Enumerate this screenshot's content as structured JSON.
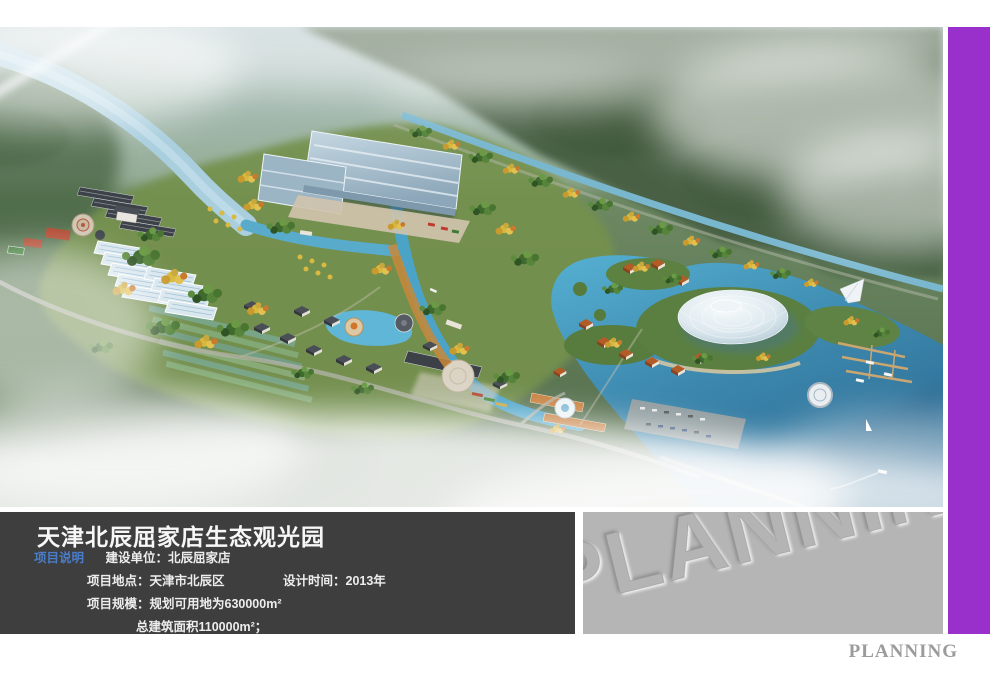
{
  "board": {
    "title": "天津北辰屈家店生态观光园",
    "section_label": "项目说明",
    "owner": "建设单位：北辰屈家店",
    "location": "项目地点：天津市北辰区",
    "design_time": "设计时间：2013年",
    "scale": "项目规模：规划可用地为630000m²",
    "area": "总建筑面积110000m²；"
  },
  "watermark": {
    "embossed": "PLANNING",
    "footer": "PLANNING"
  },
  "colors": {
    "accent_purple": "#9a30cc",
    "info_panel_bg": "#3e3e3e",
    "watermark_panel_bg": "#b5b5b5",
    "section_label_blue": "#4a7cc7",
    "canal_water": "#49a4c6",
    "deep_lake_water": "#2e6d95",
    "river_water": "#a9cede",
    "foliage_green": "#5a7f41",
    "autumn_foliage": "#d8b83e"
  }
}
